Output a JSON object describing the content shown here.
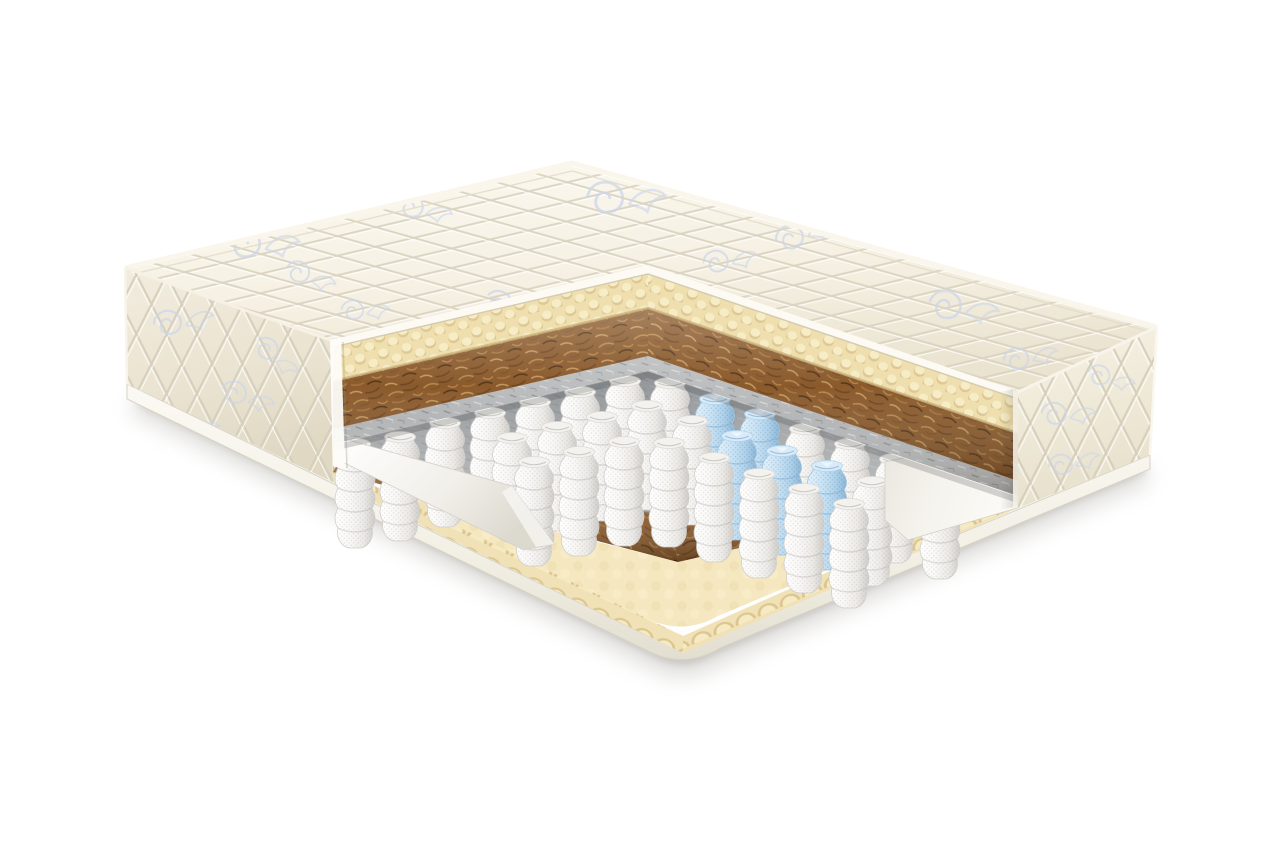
{
  "meta": {
    "title": "Cutaway illustration of an orthopedic pocket-spring mattress",
    "background": "#ffffff"
  },
  "illustration": {
    "type": "product-cutaway-render",
    "subject": "mattress with quarter cut removed showing internal layers",
    "layers": [
      {
        "name": "quilted-cover",
        "color": "#f6f2e6"
      },
      {
        "name": "egg-crate-foam",
        "color": "#f0e0ad"
      },
      {
        "name": "coconut-coir",
        "color": "#8a5a2c"
      },
      {
        "name": "felt-pad",
        "color": "#b5b7b8"
      },
      {
        "name": "pocket-springs",
        "color": "#f2f1ef"
      },
      {
        "name": "comfort-zone-springs",
        "color": "#bcdcf1"
      },
      {
        "name": "felt-pad-lower",
        "color": "#b5b7b8"
      },
      {
        "name": "coconut-coir-lower",
        "color": "#8a5a2c"
      },
      {
        "name": "egg-crate-foam-base",
        "color": "#f3e5bb"
      },
      {
        "name": "bottom-cover",
        "color": "#f7f5ee"
      }
    ],
    "springs": {
      "total": 31,
      "blue": 5,
      "positions": [
        [
          355,
          436,
          "w"
        ],
        [
          400,
          429,
          "w"
        ],
        [
          445,
          415,
          "w"
        ],
        [
          490,
          405,
          "w"
        ],
        [
          535,
          394,
          "w"
        ],
        [
          580,
          384,
          "w"
        ],
        [
          625,
          373,
          "w"
        ],
        [
          670,
          375,
          "w"
        ],
        [
          715,
          391,
          "b"
        ],
        [
          760,
          406,
          "b"
        ],
        [
          805,
          421,
          "w"
        ],
        [
          850,
          436,
          "w"
        ],
        [
          895,
          451,
          "w"
        ],
        [
          940,
          467,
          "w"
        ],
        [
          512,
          430,
          "w"
        ],
        [
          557,
          419,
          "w"
        ],
        [
          602,
          409,
          "w"
        ],
        [
          647,
          398,
          "w"
        ],
        [
          692,
          413,
          "w"
        ],
        [
          737,
          428,
          "b"
        ],
        [
          782,
          443,
          "b"
        ],
        [
          827,
          458,
          "b"
        ],
        [
          872,
          474,
          "w"
        ],
        [
          534,
          454,
          "w"
        ],
        [
          579,
          444,
          "w"
        ],
        [
          624,
          434,
          "w"
        ],
        [
          669,
          435,
          "w"
        ],
        [
          714,
          450,
          "w"
        ],
        [
          759,
          466,
          "w"
        ],
        [
          804,
          481,
          "w"
        ],
        [
          849,
          496,
          "w"
        ]
      ]
    }
  },
  "palette": {
    "background": "#ffffff",
    "fabric-top": "#f6f2e6",
    "fabric-side": "#ece5d4",
    "quilt-line": "#dcd5c2",
    "floral": "#ccd6ea",
    "foam": "#f0e0ad",
    "foam-shadow": "#d8c28e",
    "coir": "#8a5a2c",
    "coir-dark": "#5f3c1a",
    "felt": "#b5b7b8",
    "felt-dark": "#8e9092",
    "spring-white": "#f2f1ef",
    "spring-blue": "#bcdcf1",
    "encasement": "#f2efe8",
    "base-white": "#f7f5ee"
  }
}
